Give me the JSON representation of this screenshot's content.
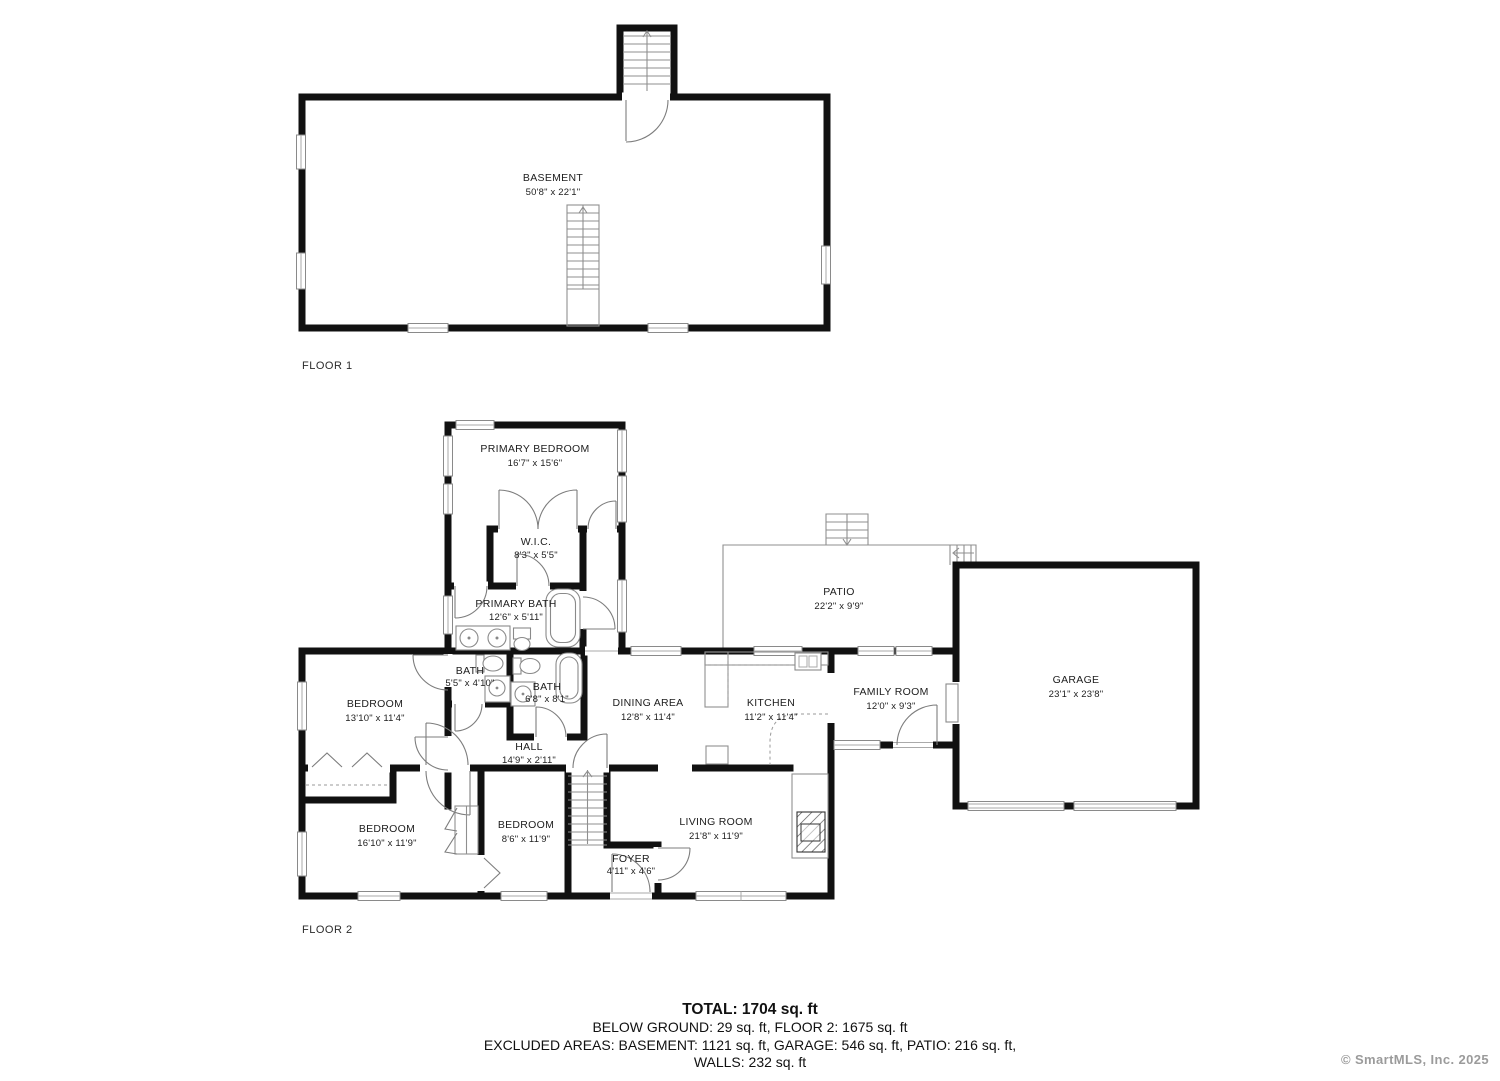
{
  "floor1": {
    "label": "FLOOR 1",
    "rooms": [
      {
        "name": "BASEMENT",
        "dims": "50'8\" x 22'1\""
      }
    ]
  },
  "floor2": {
    "label": "FLOOR 2",
    "rooms": [
      {
        "name": "PRIMARY BEDROOM",
        "dims": "16'7\" x 15'6\""
      },
      {
        "name": "W.I.C.",
        "dims": "8'3\" x 5'5\""
      },
      {
        "name": "PRIMARY BATH",
        "dims": "12'6\" x 5'11\""
      },
      {
        "name": "BATH",
        "dims": "5'5\" x 4'10\""
      },
      {
        "name": "BATH",
        "dims": "6'8\" x 8'1\""
      },
      {
        "name": "BEDROOM",
        "dims": "13'10\" x 11'4\""
      },
      {
        "name": "DINING AREA",
        "dims": "12'8\" x 11'4\""
      },
      {
        "name": "KITCHEN",
        "dims": "11'2\" x 11'4\""
      },
      {
        "name": "FAMILY ROOM",
        "dims": "12'0\" x 9'3\""
      },
      {
        "name": "GARAGE",
        "dims": "23'1\" x 23'8\""
      },
      {
        "name": "PATIO",
        "dims": "22'2\" x 9'9\""
      },
      {
        "name": "HALL",
        "dims": "14'9\" x 2'11\""
      },
      {
        "name": "BEDROOM",
        "dims": "16'10\" x 11'9\""
      },
      {
        "name": "BEDROOM",
        "dims": "8'6\" x 11'9\""
      },
      {
        "name": "LIVING ROOM",
        "dims": "21'8\" x 11'9\""
      },
      {
        "name": "FOYER",
        "dims": "4'11\" x 4'6\""
      }
    ]
  },
  "summary": {
    "total": "TOTAL: 1704 sq. ft",
    "line1": "BELOW GROUND: 29 sq. ft, FLOOR 2: 1675 sq. ft",
    "line2": "EXCLUDED AREAS: BASEMENT: 1121 sq. ft, GARAGE: 546 sq. ft, PATIO: 216 sq. ft,",
    "line3": "WALLS: 232 sq. ft"
  },
  "watermark": "© SmartMLS, Inc.  2025",
  "colors": {
    "wall": "#111111",
    "accent": "#8f8f8f",
    "watermark": "#9b9b9b"
  }
}
